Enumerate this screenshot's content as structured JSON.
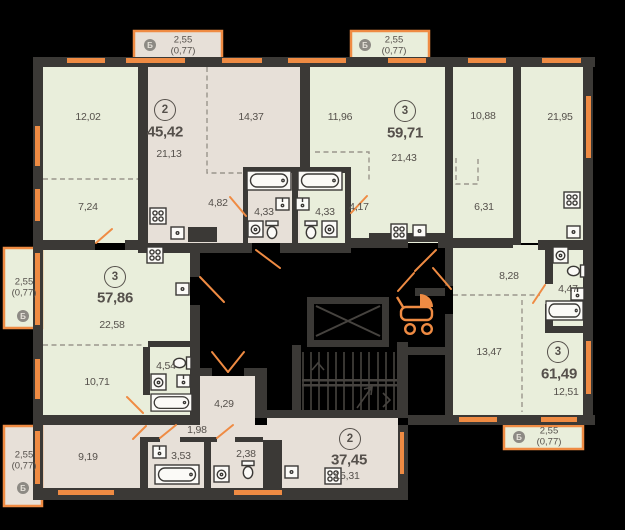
{
  "colors": {
    "background": "#000000",
    "wall": "#3b3936",
    "apartment_green": "#e9eedb",
    "apartment_beige": "#e7e0d8",
    "accent_orange": "#ef8b43",
    "label_text": "#55504b",
    "balcony_badge": "#8d8a84"
  },
  "core": {
    "stroller_icon": "stroller",
    "elevator_icon": "elevator-cross",
    "stairs_icon": "stairs"
  },
  "apartments": [
    {
      "id": "apt-45-42",
      "rooms_count": "2",
      "total_area": "45,42",
      "room_areas": {
        "living_kitchen": "21,13",
        "bedroom": "14,37",
        "hallway": "4,82",
        "bathroom": "4,33"
      }
    },
    {
      "id": "apt-59-71",
      "rooms_count": "3",
      "total_area": "59,71",
      "room_areas": {
        "bedroom_1": "11,96",
        "living_kitchen": "21,43",
        "bedroom_2": "10,88",
        "room": "6,31",
        "hallway": "4,17",
        "bathroom": "4,33"
      }
    },
    {
      "id": "apt-57-86",
      "rooms_count": "3",
      "total_area": "57,86",
      "room_areas": {
        "bedroom_1": "12,02",
        "bedroom_2": "7,24",
        "living_kitchen": "22,58",
        "bedroom_3": "10,71",
        "bathroom": "4,54"
      }
    },
    {
      "id": "apt-61-49",
      "rooms_count": "3",
      "total_area": "61,49",
      "room_areas": {
        "living_kitchen": "21,95",
        "hallway": "8,28",
        "bathroom": "4,47",
        "bedroom_1": "13,47",
        "bedroom_2": "12,51"
      }
    },
    {
      "id": "apt-37-45",
      "rooms_count": "2",
      "total_area": "37,45",
      "room_areas": {
        "bedroom": "9,19",
        "living_kitchen": "15,31",
        "bathroom": "3,53",
        "wc": "2,38",
        "hall": "1,98",
        "corridor": "4,29"
      }
    }
  ],
  "balconies": [
    {
      "letter": "Б",
      "area": "2,55",
      "reduced_area": "(0,77)"
    },
    {
      "letter": "Б",
      "area": "2,55",
      "reduced_area": "(0,77)"
    },
    {
      "letter": "Б",
      "area": "2,55",
      "reduced_area": "(0,77)"
    },
    {
      "letter": "Б",
      "area": "2,55",
      "reduced_area": "(0,77)"
    },
    {
      "letter": "Б",
      "area": "2,55",
      "reduced_area": "(0,77)"
    }
  ]
}
